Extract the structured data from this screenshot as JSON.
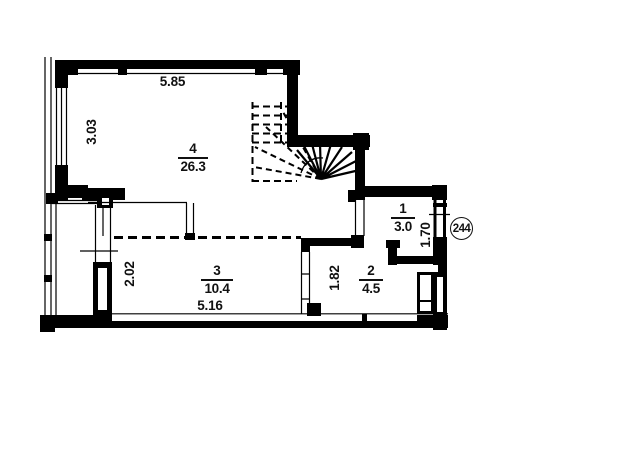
{
  "plan": {
    "apartment_number": "244",
    "rooms": [
      {
        "number": "4",
        "area": "26.3"
      },
      {
        "number": "3",
        "area": "10.4"
      },
      {
        "number": "2",
        "area": "4.5"
      },
      {
        "number": "1",
        "area": "3.0"
      }
    ],
    "dims": {
      "top_width": "5.85",
      "left_height": "3.03",
      "room3_width": "5.16",
      "room3_depth": "2.02",
      "room2_depth": "1.82",
      "room1_depth": "1.70"
    }
  }
}
